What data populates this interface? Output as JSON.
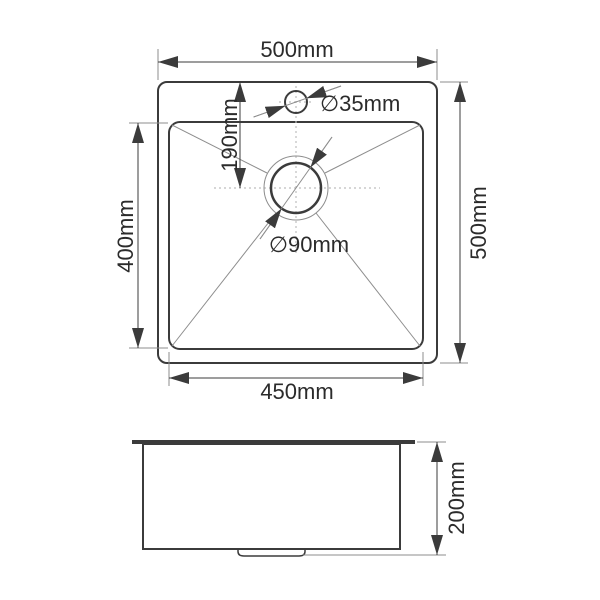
{
  "top_view": {
    "overall_width": "500mm",
    "overall_depth": "500mm",
    "bowl_width": "450mm",
    "bowl_depth": "400mm",
    "drain_center_offset": "190mm",
    "faucet_hole_diameter": "∅35mm",
    "drain_diameter": "∅90mm"
  },
  "side_view": {
    "height": "200mm"
  },
  "colors": {
    "outline": "#3b3b3b",
    "dimension_line": "#3b3b3b",
    "thin_line": "#8d8d8d",
    "centerline": "#bdbdbd",
    "text": "#2b2b2b",
    "background": "#ffffff"
  }
}
